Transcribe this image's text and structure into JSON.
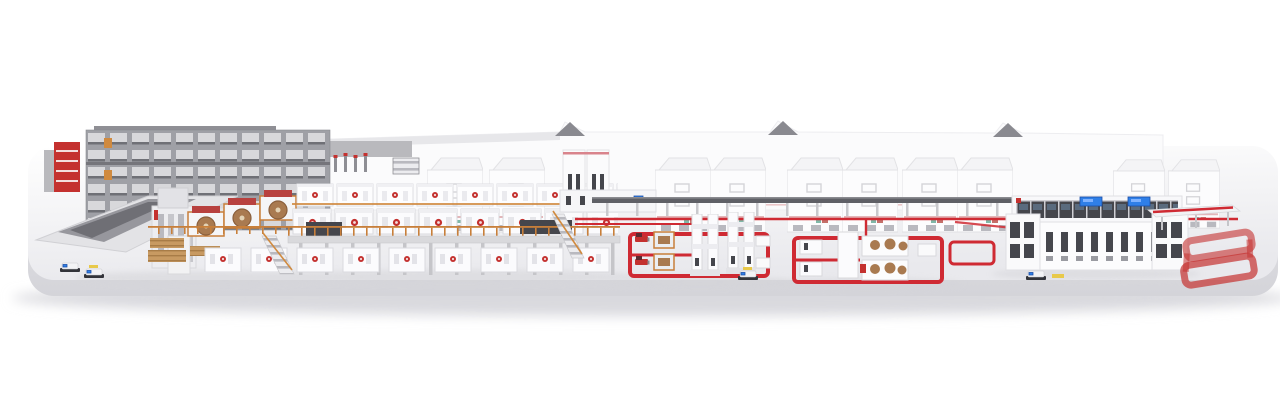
{
  "meta": {
    "title": "3D rendering of a complete corrugated board production plant line on a white platform",
    "background": "#ffffff"
  },
  "colors": {
    "background": "#ffffff",
    "accent": "#c4312f",
    "accent_soft": "#cf2a33",
    "orange": "#c87f3a",
    "roll_brown": "#a97a50",
    "dark_panel": "#45464c",
    "screen_blue": "#2f7fe8",
    "conveyor_dark": "#5f6066",
    "machine_white": "#fcfcfd",
    "outline": "#dcdce0",
    "platform_top": "#f3f3f5",
    "platform_side": "#dfdfe3",
    "wall": "#fbfbfc",
    "rack_gray": "#9fa0a6",
    "shadow": "#c9c9ce",
    "yellow": "#e8c94a"
  },
  "scene": {
    "sections": [
      {
        "id": "roll-storage-rack",
        "label": "red roll storage rack"
      },
      {
        "id": "high-bay-storage",
        "label": "gray high-bay roll storage"
      },
      {
        "id": "roll-ramp",
        "label": "roll handling ramp"
      },
      {
        "id": "wet-end-splicers",
        "label": "splicer roll stands with paper rolls"
      },
      {
        "id": "corrugator-bridge",
        "label": "elevated corrugator bridge with machine modules"
      },
      {
        "id": "dry-end",
        "label": "dry end cut-off and stacker"
      },
      {
        "id": "backdrop-wall",
        "label": "white factory wall with gable roofs"
      },
      {
        "id": "box-machines",
        "label": "row of large white box machines"
      },
      {
        "id": "conversion-loop-1",
        "label": "conversion line 1 inside red floor loop"
      },
      {
        "id": "conversion-loop-2",
        "label": "conversion line 2 inside red floor loop"
      },
      {
        "id": "sorting-line",
        "label": "long sorting machine with blue screens"
      },
      {
        "id": "shipping-loop",
        "label": "red shipping loop conveyor"
      },
      {
        "id": "agv-vehicles",
        "label": "automated guided vehicles"
      }
    ]
  }
}
